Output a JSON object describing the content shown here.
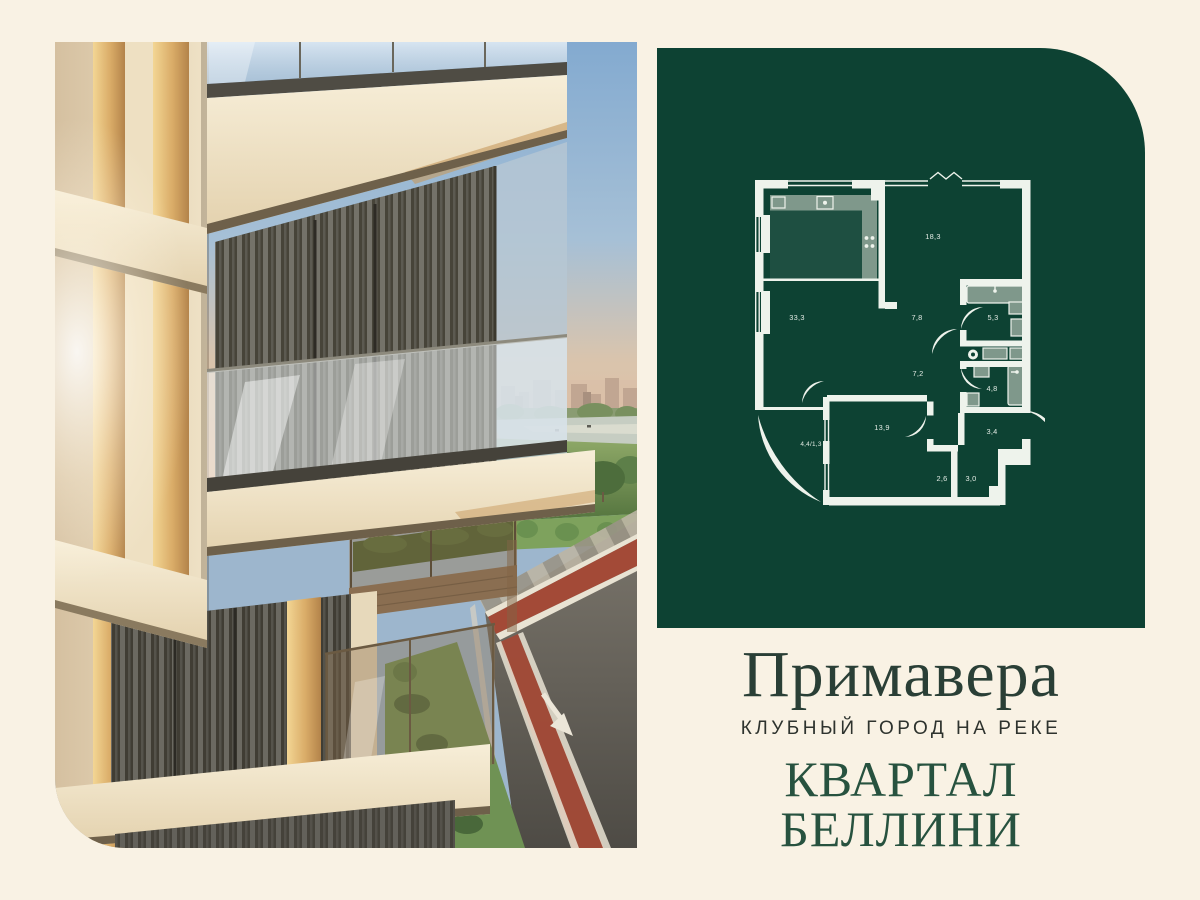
{
  "colors": {
    "page-bg": "#f9f2e4",
    "panel-bg": "#0d4233",
    "plan-line": "#eef3ec",
    "title": "#2a3f36",
    "subtitle": "#2e332e",
    "quarter": "#27523f"
  },
  "branding": {
    "project_name": "Примавера",
    "tagline": "КЛУБНЫЙ ГОРОД НА РЕКЕ",
    "quarter_name": "КВАРТАЛ БЕЛЛИНИ"
  },
  "plan": {
    "rooms": [
      {
        "id": "living-room",
        "area": "33,3"
      },
      {
        "id": "bedroom",
        "area": "18,3"
      },
      {
        "id": "kitchen-corridor",
        "area": "7,8"
      },
      {
        "id": "bathroom-1",
        "area": "5,3"
      },
      {
        "id": "hall",
        "area": "7,2"
      },
      {
        "id": "bathroom-2",
        "area": "4,8"
      },
      {
        "id": "room-2",
        "area": "13,9"
      },
      {
        "id": "balcony",
        "area": "4,4/1,3"
      },
      {
        "id": "hallway",
        "area": "3,4"
      },
      {
        "id": "storage-1",
        "area": "2,6"
      },
      {
        "id": "storage-2",
        "area": "3,0"
      }
    ]
  }
}
